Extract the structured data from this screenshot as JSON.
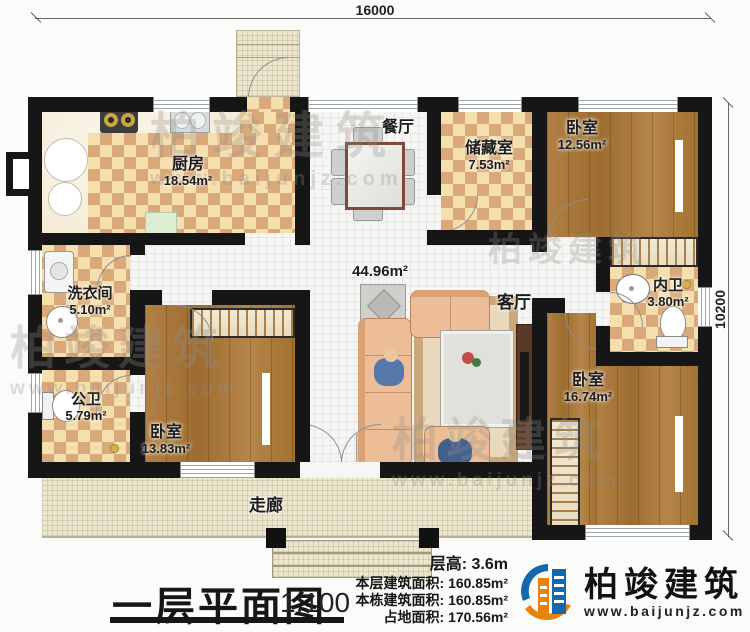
{
  "dimensions": {
    "top": "16000",
    "right": "10200"
  },
  "rooms": {
    "kitchen": {
      "label": "厨房",
      "area": "18.54m²"
    },
    "dining": {
      "label": "餐厅"
    },
    "storage": {
      "label": "储藏室",
      "area": "7.53m²"
    },
    "bedroom_top": {
      "label": "卧室",
      "area": "12.56m²"
    },
    "laundry": {
      "label": "洗衣间",
      "area": "5.10m²"
    },
    "public_bath": {
      "label": "公卫",
      "area": "5.79m²"
    },
    "bedroom_left": {
      "label": "卧室",
      "area": "13.83m²"
    },
    "living": {
      "label": "客厅",
      "area": "44.96m²"
    },
    "inner_bath": {
      "label": "内卫",
      "area": "3.80m²"
    },
    "bedroom_right": {
      "label": "卧室",
      "area": "16.74m²"
    },
    "corridor": {
      "label": "走廊"
    }
  },
  "titleblock": {
    "title": "一层平面图",
    "scale": "1:100"
  },
  "info": [
    {
      "label": "层高:",
      "value": "3.6m"
    },
    {
      "label": "本层建筑面积:",
      "value": "160.85m²"
    },
    {
      "label": "本栋建筑面积:",
      "value": "160.85m²"
    },
    {
      "label": "占地面积:",
      "value": "170.56m²"
    }
  ],
  "brand": {
    "name": "柏竣建筑",
    "url": "www.baijunjz.com"
  },
  "watermark": {
    "name": "柏竣建筑",
    "url": "www.baijunjz.com"
  },
  "colors": {
    "accent_blue": "#1767ad",
    "accent_orange": "#e8820c",
    "wall": "#161616"
  }
}
